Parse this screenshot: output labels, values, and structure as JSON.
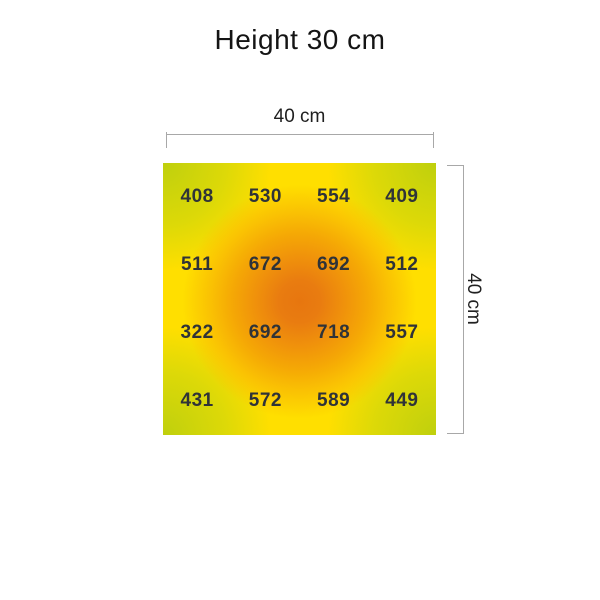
{
  "title": "Height 30 cm",
  "dimensions": {
    "width_label": "40 cm",
    "height_label": "40 cm"
  },
  "chart_data": {
    "type": "heatmap",
    "title": "Height 30 cm",
    "rows": 4,
    "cols": 4,
    "values": [
      [
        408,
        530,
        554,
        409
      ],
      [
        511,
        672,
        692,
        512
      ],
      [
        322,
        692,
        718,
        557
      ],
      [
        431,
        572,
        589,
        449
      ]
    ],
    "value_min": 322,
    "value_max": 718,
    "area_width_label": "40 cm",
    "area_height_label": "40 cm",
    "legend": "none",
    "colors": {
      "corner_low": "#c5d70e",
      "edge_mid": "#ffdf00",
      "center_high": "#e7760f",
      "value_text": "#2f3338",
      "dimension_line": "#a8a8a8",
      "background": "#ffffff"
    }
  }
}
